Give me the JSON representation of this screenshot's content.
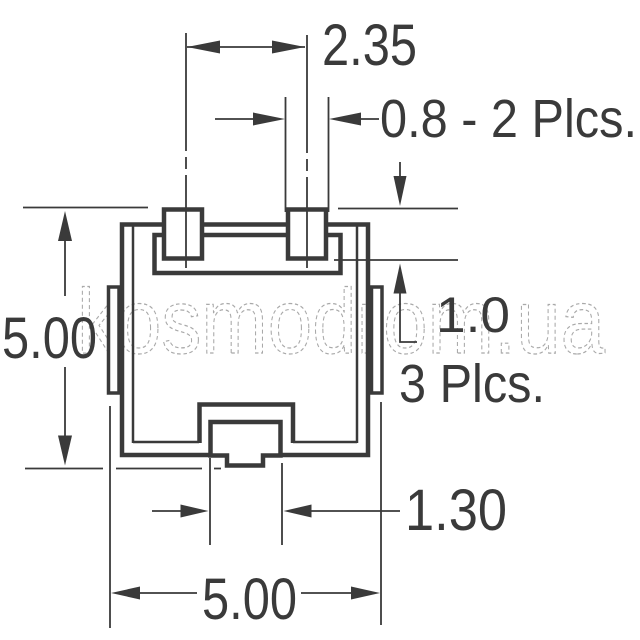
{
  "drawing": {
    "type": "technical-dimension-drawing",
    "labels": {
      "top_lead_spacing": "2.35",
      "top_lead_width": "0.8 - 2 Plcs.",
      "body_height": "5.00",
      "lead_length": "1.0",
      "lead_length_places": "3 Plcs.",
      "bottom_lead_width": "1.30",
      "body_width": "5.00"
    }
  },
  "watermark": {
    "text": "kosmodrom.ua"
  },
  "colors": {
    "line": "#3a3a3a",
    "background": "#ffffff",
    "watermark": "#a9a9a9"
  }
}
